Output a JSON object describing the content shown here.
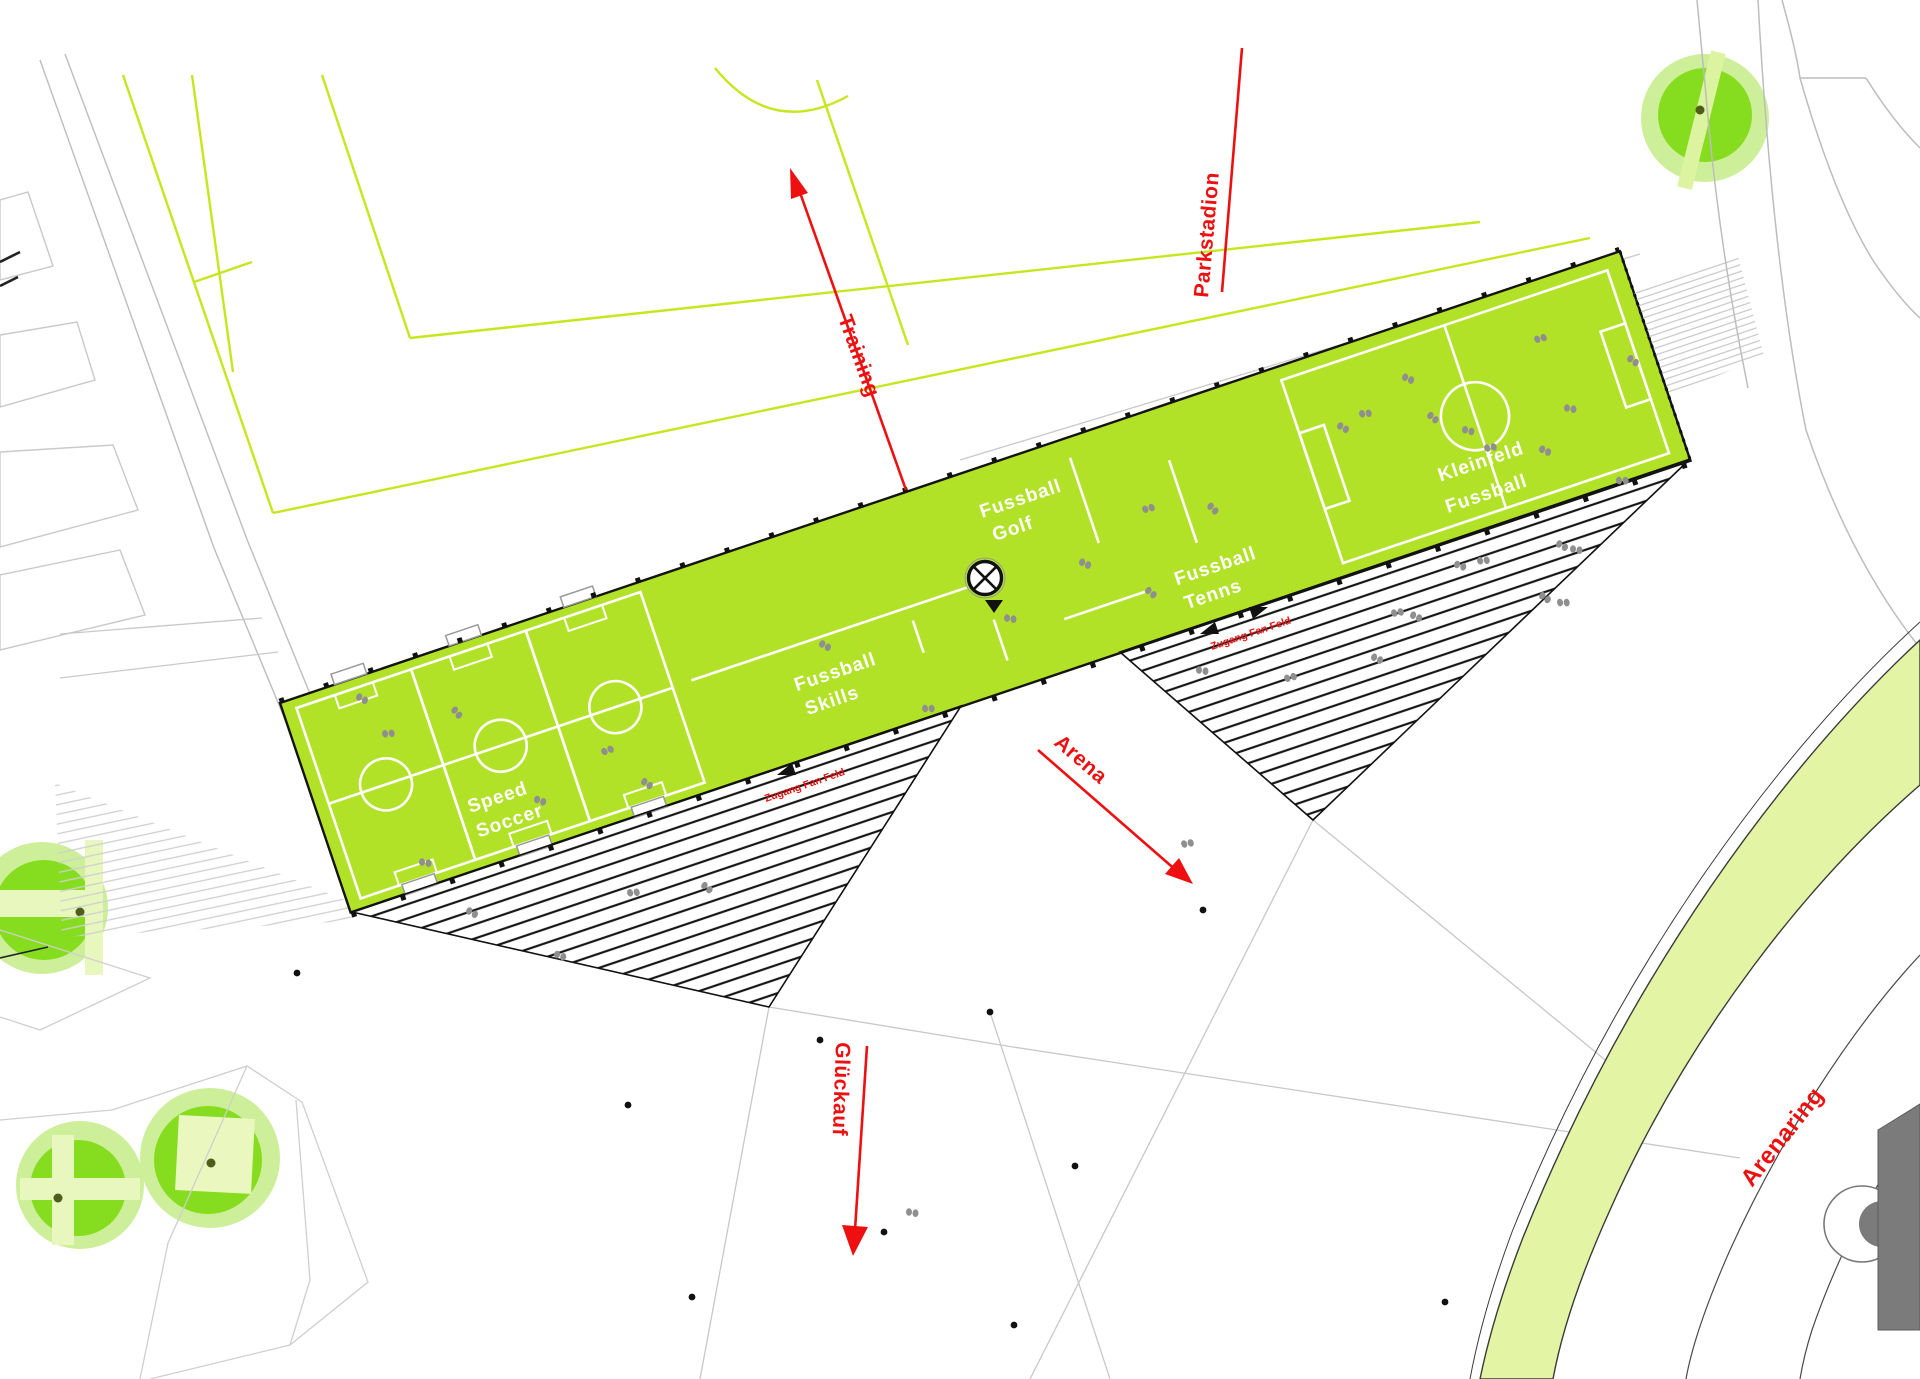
{
  "plan": {
    "title": "Arena sports plaza site plan",
    "annotations": {
      "training": "Training",
      "parkstadion": "Parkstadion",
      "arena": "Arena",
      "glueckauf": "Glückauf",
      "arenaring": "Arenaring",
      "zugang_left": "Zugang Fan Feld",
      "zugang_right": "Zugang Fan Feld"
    },
    "areas": {
      "speed_soccer": [
        "Speed",
        "Soccer"
      ],
      "skills": [
        "Fussball",
        "Skills"
      ],
      "golf": [
        "Fussball",
        "Golf"
      ],
      "tennis": [
        "Fussball",
        "Tenns"
      ],
      "kleinfeld": [
        "Kleinfeld",
        "Fussball"
      ]
    },
    "colors": {
      "band_green": "#b2e228",
      "outline_chartreuse": "#c4e71e",
      "tree_pale": "#cdef9a",
      "tree_bright": "#86dd1f",
      "ring_band": "#e3f4a4",
      "annotation_red": "#ee1010",
      "building_gray": "#7b7b7b",
      "hatch_black": "#161616",
      "people_gray": "#8f8f8f"
    },
    "symbols": {
      "people": [
        [
          362,
          698,
          20
        ],
        [
          388,
          733,
          -15
        ],
        [
          457,
          712,
          40
        ],
        [
          540,
          800,
          10
        ],
        [
          607,
          750,
          -30
        ],
        [
          647,
          783,
          25
        ],
        [
          425,
          862,
          0
        ],
        [
          825,
          645,
          20
        ],
        [
          928,
          708,
          -10
        ],
        [
          1085,
          563,
          15
        ],
        [
          1148,
          508,
          -25
        ],
        [
          1213,
          508,
          35
        ],
        [
          1010,
          618,
          0
        ],
        [
          1343,
          427,
          20
        ],
        [
          1365,
          413,
          -15
        ],
        [
          1433,
          417,
          30
        ],
        [
          1468,
          430,
          5
        ],
        [
          1490,
          447,
          -20
        ],
        [
          1545,
          450,
          15
        ],
        [
          1622,
          480,
          -10
        ],
        [
          1633,
          360,
          25
        ],
        [
          1570,
          408,
          0
        ],
        [
          1408,
          378,
          15
        ],
        [
          1540,
          338,
          -25
        ],
        [
          1460,
          565,
          10
        ],
        [
          1483,
          560,
          -15
        ],
        [
          1562,
          545,
          20
        ],
        [
          1576,
          549,
          0
        ],
        [
          1397,
          612,
          -20
        ],
        [
          1416,
          616,
          15
        ],
        [
          1545,
          597,
          25
        ],
        [
          1563,
          602,
          -10
        ],
        [
          1151,
          592,
          30
        ],
        [
          1202,
          670,
          0
        ],
        [
          1290,
          677,
          -25
        ],
        [
          1377,
          658,
          15
        ],
        [
          472,
          912,
          20
        ],
        [
          633,
          892,
          -15
        ],
        [
          707,
          887,
          30
        ],
        [
          560,
          955,
          10
        ],
        [
          912,
          1212,
          0
        ],
        [
          1187,
          843,
          -20
        ]
      ],
      "dots": [
        [
          820,
          1040
        ],
        [
          628,
          1105
        ],
        [
          884,
          1232
        ],
        [
          1075,
          1166
        ],
        [
          692,
          1297
        ],
        [
          1014,
          1325
        ],
        [
          1445,
          1302
        ],
        [
          1203,
          910
        ],
        [
          297,
          973
        ],
        [
          990,
          1012
        ]
      ]
    }
  }
}
